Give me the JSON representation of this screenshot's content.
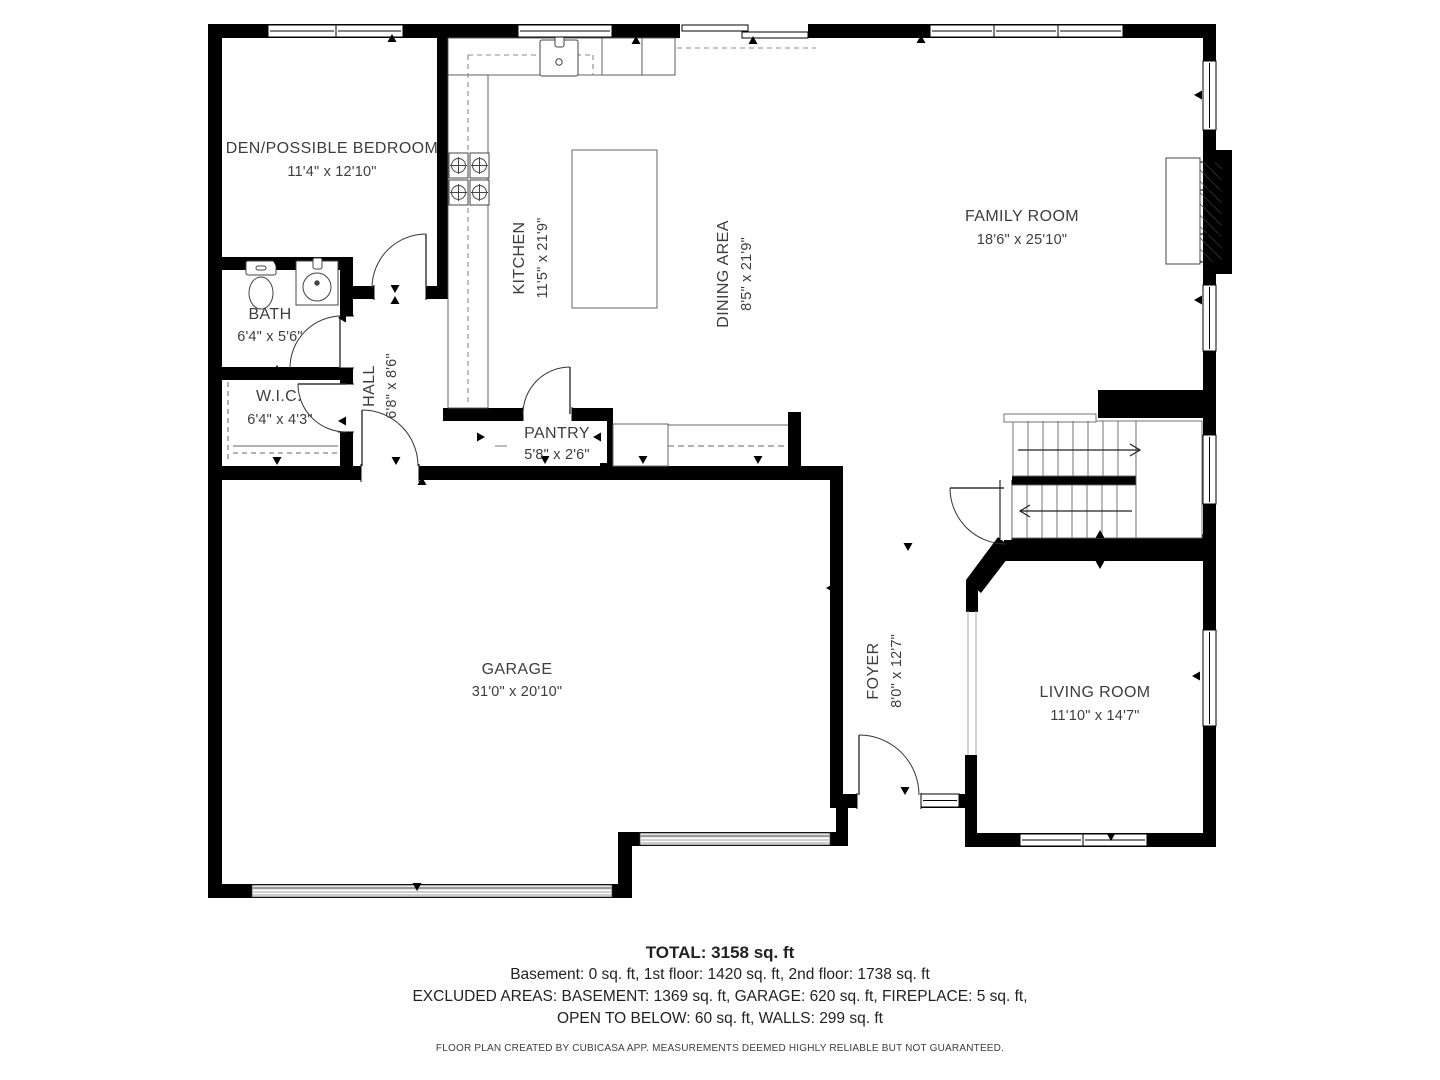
{
  "rooms": {
    "den": {
      "name": "DEN/POSSIBLE BEDROOM",
      "dims": "11'4\" x 12'10\""
    },
    "bath": {
      "name": "BATH",
      "dims": "6'4\" x 5'6\""
    },
    "wic": {
      "name": "W.I.C.",
      "dims": "6'4\" x 4'3\""
    },
    "hall": {
      "name": "HALL",
      "dims": "6'8\" x 8'6\""
    },
    "kitchen": {
      "name": "KITCHEN",
      "dims": "11'5\" x 21'9\""
    },
    "dining": {
      "name": "DINING AREA",
      "dims": "8'5\" x 21'9\""
    },
    "pantry": {
      "name": "PANTRY",
      "dims": "5'8\" x 2'6\""
    },
    "family": {
      "name": "FAMILY ROOM",
      "dims": "18'6\" x 25'10\""
    },
    "garage": {
      "name": "GARAGE",
      "dims": "31'0\" x 20'10\""
    },
    "foyer": {
      "name": "FOYER",
      "dims": "8'0\" x 12'7\""
    },
    "living": {
      "name": "LIVING ROOM",
      "dims": "11'10\" x 14'7\""
    }
  },
  "summary": {
    "total": "TOTAL: 3158 sq. ft",
    "floors": "Basement: 0 sq. ft, 1st floor: 1420 sq. ft, 2nd floor: 1738 sq. ft",
    "excluded_1": "EXCLUDED AREAS: BASEMENT: 1369 sq. ft, GARAGE: 620 sq. ft, FIREPLACE: 5 sq. ft,",
    "excluded_2": "OPEN TO BELOW: 60 sq. ft, WALLS: 299 sq. ft",
    "disclaimer": "FLOOR PLAN CREATED BY CUBICASA APP. MEASUREMENTS DEEMED HIGHLY RELIABLE BUT NOT GUARANTEED."
  },
  "colors": {
    "wall": "#000000",
    "thin_line": "#555555",
    "dashed_line": "#8a8a8a",
    "garage_door_stripe": "#9a9a9a",
    "label_text": "#3d3d3d"
  }
}
